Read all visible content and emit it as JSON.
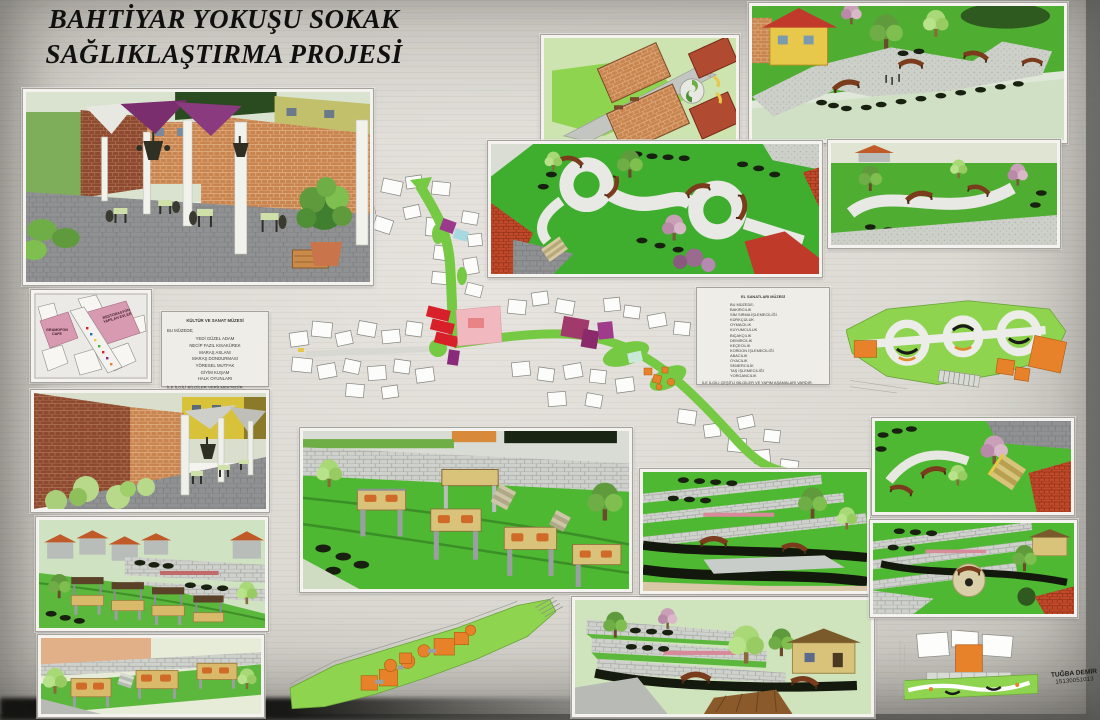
{
  "poster": {
    "title_line1": "BAHTİYAR YOKUŞU SOKAK",
    "title_line2": "SAĞLIKLAŞTIRMA PROJESİ"
  },
  "key_plan": {
    "restored_label": "RESTORASYON YAPILAN EVLER",
    "cafe_label": "GRAMOFON CAFE"
  },
  "culture_museum_note": {
    "title": "KÜLTÜR VE SANAT MÜZESİ",
    "intro": "BU MÜZEDE;",
    "items": [
      "YEDİ GÜZEL ADAM",
      "NECİP FAZIL KISAKÜREK",
      "MARAŞ ASLANI",
      "MARAŞ DONDURMASI",
      "YÖRESEL MUTFAK",
      "GİYİM KUŞAM",
      "HALK OYUNLARI"
    ],
    "outro": "İLE İLGİLİ BİLGİLER VERİLMEKTEDİR."
  },
  "crafts_museum_note": {
    "title": "EL SANATLARI MÜZESİ",
    "intro": "BU MÜZEDE;",
    "items": [
      "BAKIRCILIK",
      "SİM SIRMA İŞLEMECİLİĞİ",
      "KÜRKÇÜLÜK",
      "OYMACILIK",
      "KUYUMCULUK",
      "BIÇAKÇILIK",
      "DEMİRCİLİK",
      "KEÇECİLİK",
      "KORDON İŞLEMECİLİĞİ",
      "ABACILIK",
      "OYACILIK",
      "SEMERCİLİK",
      "TAŞ İŞLEMECİLİĞİ",
      "YORGANCILIK"
    ],
    "outro": "İLE İLGİLİ ÇEŞİTLİ BİLGİLER VE YAPIM AŞAMALARI VARDIR."
  },
  "signature": {
    "name": "TUĞBA DEMİR",
    "student_id": "15130051013"
  },
  "palette": {
    "lawn_green": "#4fae32",
    "plan_green": "#8fd44f",
    "brick_orange": "#c9854f",
    "accent_orange": "#e8822a",
    "roof_red": "#c14a2a",
    "highlight_pink": "#f2b8c0",
    "highlight_red": "#d8202a",
    "highlight_magenta": "#a03a8a",
    "sail_purple": "#7a2e6e"
  }
}
